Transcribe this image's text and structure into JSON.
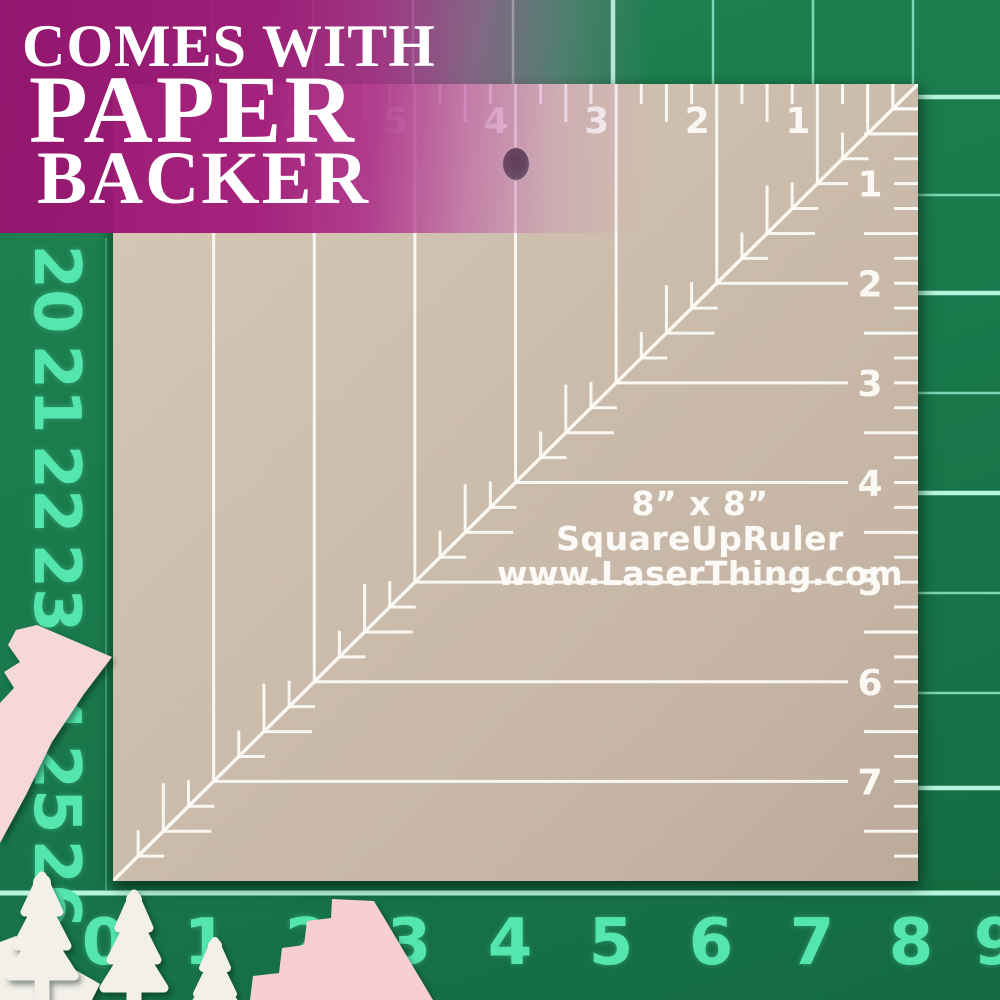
{
  "banner": {
    "line1": "COMES WITH",
    "line2": "PAPER",
    "line3": "BACKER",
    "background_color": "#a1197a",
    "text_color": "#ffffff"
  },
  "ruler": {
    "size_label": "8” x 8”",
    "brand": "SquareUpRuler",
    "website": "www.LaserThing.com",
    "top_scale": [
      "7",
      "6",
      "5",
      "4",
      "3",
      "2",
      "1"
    ],
    "right_scale": [
      "1",
      "2",
      "3",
      "4",
      "5",
      "6",
      "7"
    ],
    "total_inches": 8,
    "paper_color": "#cdbdad",
    "marking_color": "#fdfcf8"
  },
  "mat": {
    "left_scale": [
      "20",
      "21",
      "22",
      "23",
      "24",
      "25",
      "26"
    ],
    "bottom_scale": [
      "0",
      "1",
      "2",
      "3",
      "4",
      "5",
      "6",
      "7",
      "8",
      "9"
    ],
    "surface_color": "#1a7a4c",
    "grid_line_color": "#8fe7c6",
    "number_color": "#55e5ae"
  },
  "cutouts": {
    "pink_color": "#f7d8da",
    "white_color": "#f3f0e9",
    "pieces": [
      "pink-arrow",
      "pink-staircase",
      "tree-a",
      "tree-b",
      "tree-c",
      "sprue-bar"
    ]
  }
}
